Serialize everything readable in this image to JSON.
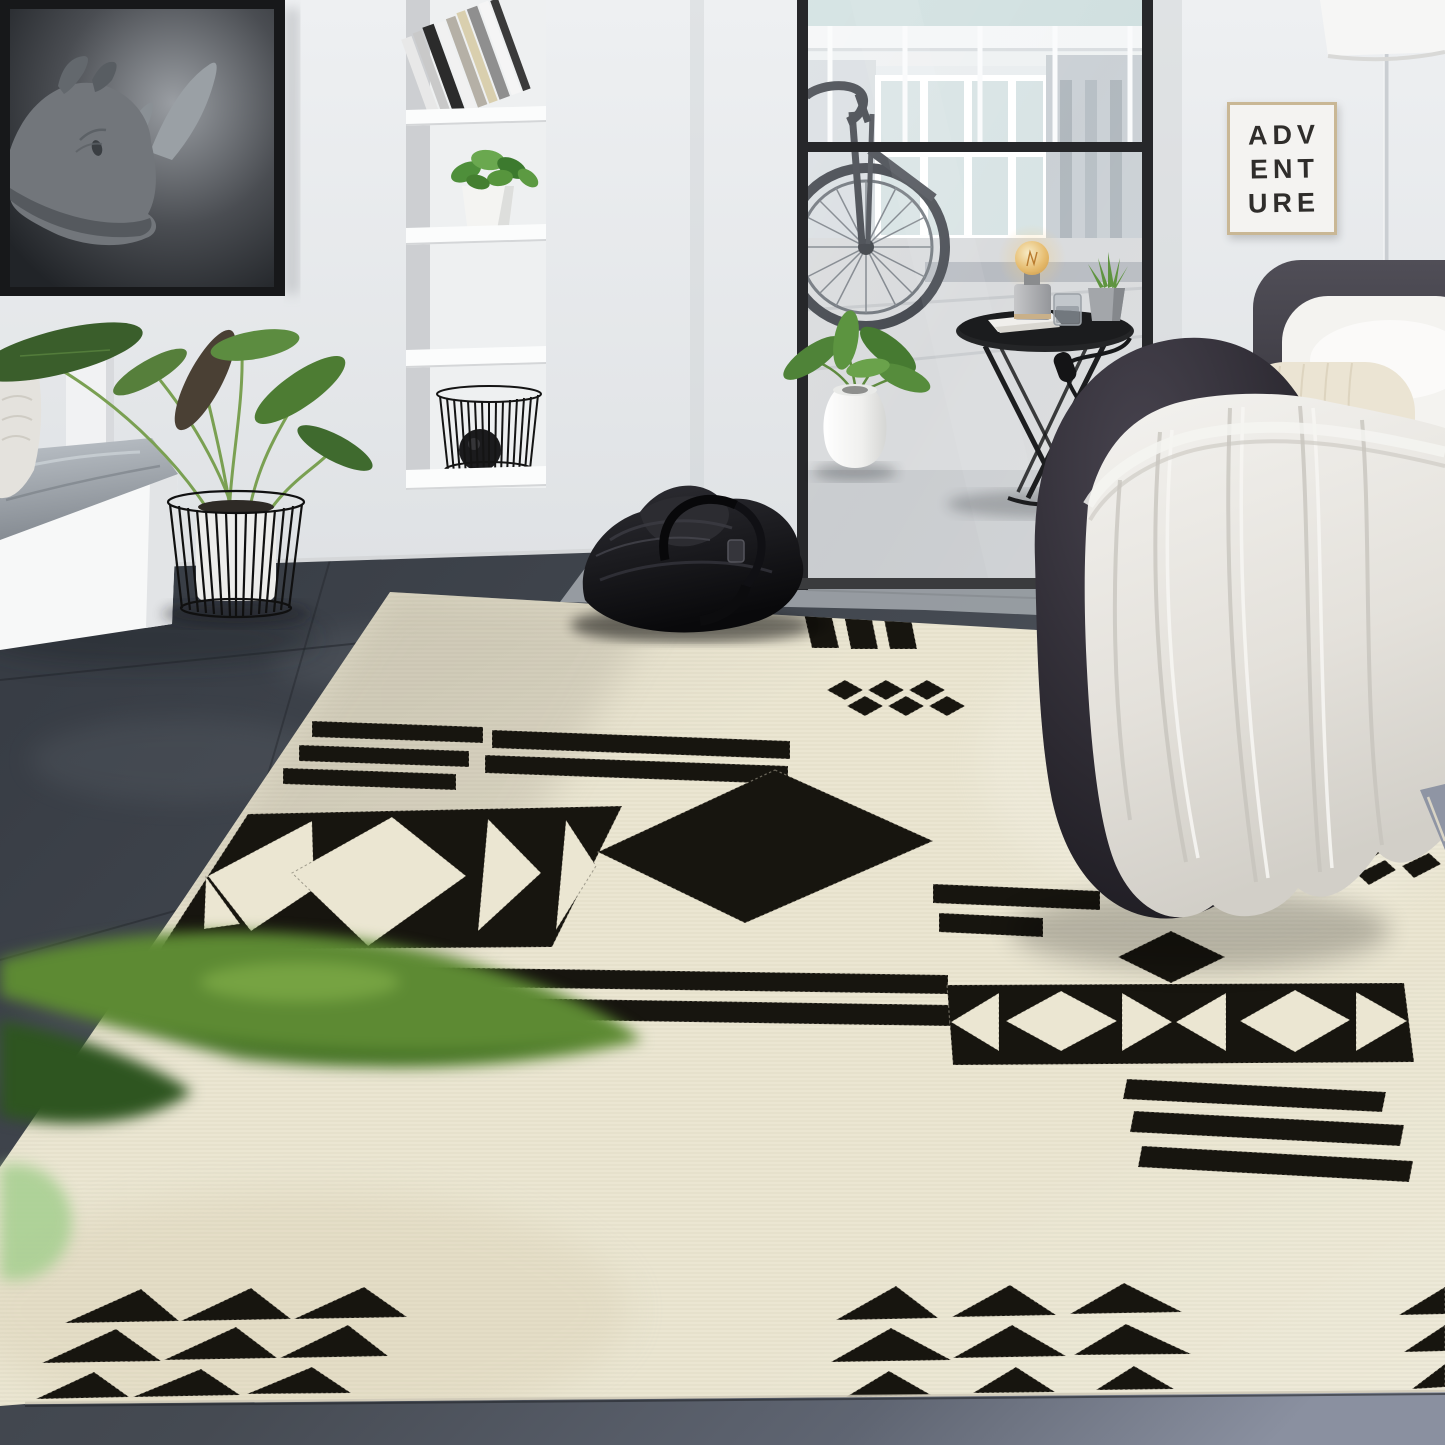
{
  "scene": {
    "type": "natural-image",
    "description": "Modern living room product photo of a cream area rug with black tribal geometric pattern (stripes, diamonds, kilim band, triangle rows)",
    "poster": {
      "line1": "ADV",
      "line2": "ENT",
      "line3": "URE"
    },
    "artwork": {
      "subject": "black and white rhinoceros photograph in black frame"
    },
    "objects": [
      "rhino-artwork",
      "wall-shelving-niche",
      "leaning-books",
      "shelf-plant",
      "wire-basket-with-ball",
      "white-bench",
      "potted-alocasia-plant",
      "glass-partition",
      "bicycle",
      "balcony-view",
      "white-vase-plant",
      "black-side-table",
      "edison-bulb-lamp",
      "succulent-pot",
      "glass-cup",
      "adventure-poster",
      "floor-lamp",
      "dark-sofa",
      "white-knit-pillow",
      "cream-bolster",
      "dark-pouf",
      "cream-throw-blanket",
      "black-leather-bag",
      "geometric-area-rug",
      "foreground-blurred-leaves",
      "slate-tile-floor"
    ]
  },
  "colors": {
    "rug-cream": "#ebe6d2",
    "rug-black": "#17150f",
    "wall": "#e7e9ec",
    "floor-dark": "#3f444c",
    "floor-light": "#9ba0a5",
    "floor-blue": "#8d93a2",
    "blanket": "#e9e7e1",
    "pouf": "#2b2830",
    "sofa-dark": "#3a3840",
    "glass-frame": "#26272a",
    "poster-bg": "#f4f3f1",
    "poster-ink": "#2f2d2b",
    "frame-wood": "#c9b795",
    "plant-green": "#4d7c33",
    "bulb-amber": "#e5bb74"
  }
}
